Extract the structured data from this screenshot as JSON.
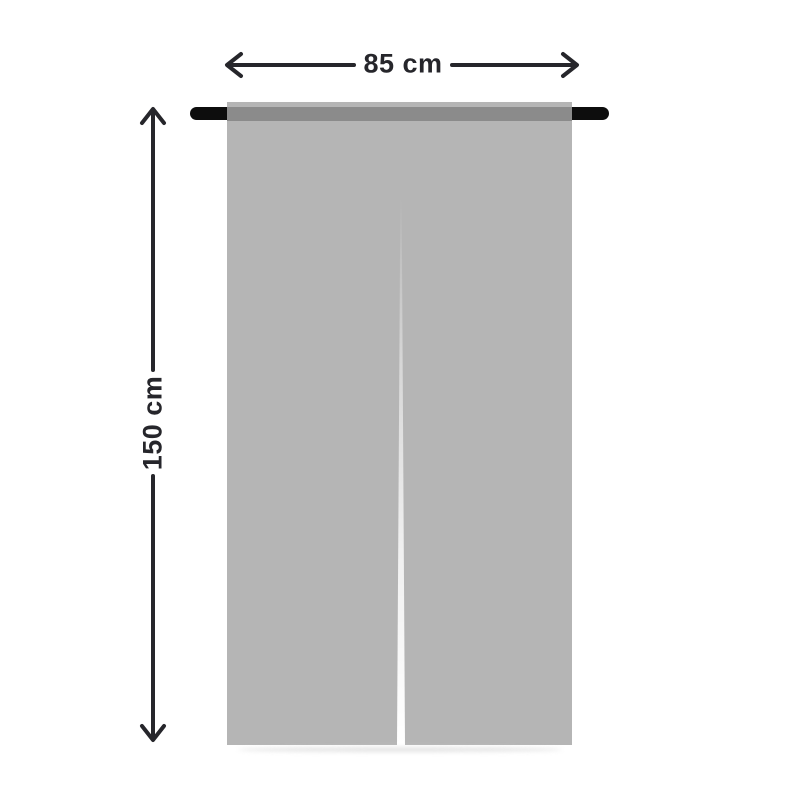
{
  "diagram": {
    "title": "curtain-dimension-diagram",
    "product": "split noren curtain on rod",
    "dimensions": {
      "width_label": "85 cm",
      "height_label": "150 cm"
    }
  },
  "colors": {
    "background": "#ffffff",
    "curtain_fabric": "#b5b5b5",
    "rod": "#0d0d0d",
    "rod_through_fabric": "#8d8d8d",
    "dimension_lines_and_text": "#26262b",
    "shadow": "#d9d9d9"
  },
  "icons": {
    "horizontal_double_arrow": "left-right measurement arrow",
    "vertical_double_arrow": "up-down measurement arrow"
  }
}
